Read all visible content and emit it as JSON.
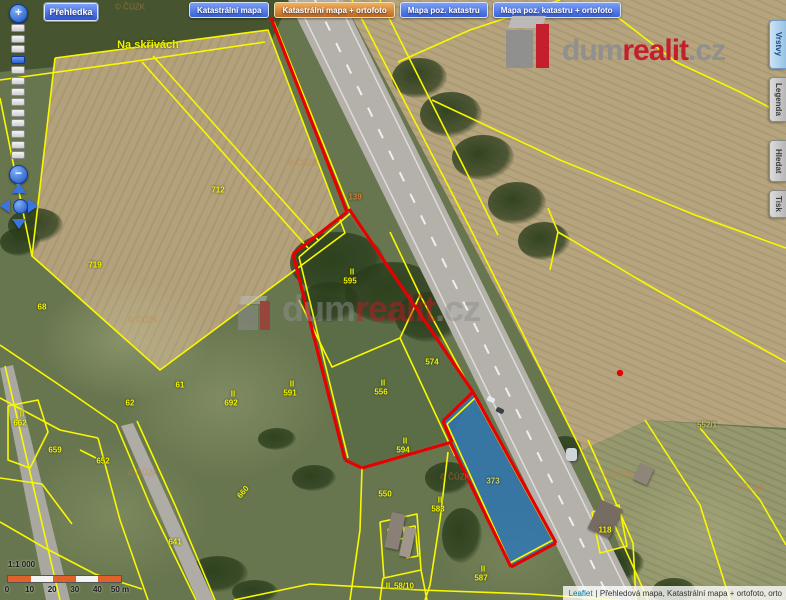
{
  "chrome": {
    "overview_button": "Přehledka",
    "map_buttons": [
      {
        "label": "Katastrální mapa",
        "active": false
      },
      {
        "label": "Katastrální mapa + ortofoto",
        "active": true
      },
      {
        "label": "Mapa poz. katastru",
        "active": false
      },
      {
        "label": "Mapa poz. katastru + ortofoto",
        "active": false
      }
    ],
    "side_tabs": [
      {
        "label": "Vrstvy",
        "active": true
      },
      {
        "label": "Legenda",
        "active": false
      },
      {
        "label": "Hledat",
        "active": false
      },
      {
        "label": "Tisk",
        "active": false
      }
    ],
    "zoom_in_glyph": "+",
    "zoom_out_glyph": "−",
    "logo": {
      "part1": "dum",
      "part2": "realit",
      "part3": ".cz"
    },
    "watermark": {
      "part1": "dum",
      "part2": "realit",
      "part3": ".cz"
    },
    "scalebar": {
      "ratio": "1:1 000",
      "ticks": [
        "0",
        "10",
        "20",
        "30",
        "40",
        "50 m"
      ]
    },
    "attribution": {
      "link": "Leaflet",
      "text": "| Přehledová mapa, Katastrální mapa + ortofoto, orto"
    }
  },
  "map": {
    "place_label": "Na skřivách",
    "copyright_text": "© ČÚZK",
    "copyright_marks": [
      {
        "x": 130,
        "y": 7
      },
      {
        "x": 303,
        "y": 163
      },
      {
        "x": 143,
        "y": 320
      },
      {
        "x": 455,
        "y": 477
      },
      {
        "x": 143,
        "y": 473
      },
      {
        "x": 618,
        "y": 475
      },
      {
        "x": 750,
        "y": 488
      }
    ],
    "labels": [
      {
        "text": "712",
        "x": 218,
        "y": 190
      },
      {
        "text": "719",
        "x": 95,
        "y": 265
      },
      {
        "text": "68",
        "x": 42,
        "y": 307
      },
      {
        "text": "61",
        "x": 180,
        "y": 385
      },
      {
        "text": "62",
        "x": 130,
        "y": 403
      },
      {
        "text": "II",
        "x": 233,
        "y": 394
      },
      {
        "text": "692",
        "x": 231,
        "y": 403
      },
      {
        "text": "II",
        "x": 22,
        "y": 414
      },
      {
        "text": "662",
        "x": 20,
        "y": 423
      },
      {
        "text": "659",
        "x": 55,
        "y": 450
      },
      {
        "text": "652",
        "x": 103,
        "y": 461
      },
      {
        "text": "641",
        "x": 175,
        "y": 542
      },
      {
        "text": "660",
        "x": 243,
        "y": 492,
        "rot": -50
      },
      {
        "text": "II",
        "x": 352,
        "y": 272
      },
      {
        "text": "595",
        "x": 350,
        "y": 281
      },
      {
        "text": "574",
        "x": 432,
        "y": 362
      },
      {
        "text": "II",
        "x": 292,
        "y": 384
      },
      {
        "text": "591",
        "x": 290,
        "y": 393
      },
      {
        "text": "II",
        "x": 383,
        "y": 383
      },
      {
        "text": "556",
        "x": 381,
        "y": 392
      },
      {
        "text": "II",
        "x": 405,
        "y": 441
      },
      {
        "text": "594",
        "x": 403,
        "y": 450
      },
      {
        "text": "550",
        "x": 385,
        "y": 494
      },
      {
        "text": "II",
        "x": 440,
        "y": 500
      },
      {
        "text": "583",
        "x": 438,
        "y": 509
      },
      {
        "text": "373",
        "x": 493,
        "y": 481,
        "cls": "inblue"
      },
      {
        "text": "II",
        "x": 483,
        "y": 569
      },
      {
        "text": "587",
        "x": 481,
        "y": 578
      },
      {
        "text": "II",
        "x": 388,
        "y": 586
      },
      {
        "text": "58/10",
        "x": 404,
        "y": 586
      },
      {
        "text": "139",
        "x": 355,
        "y": 197,
        "cls": "orange"
      },
      {
        "text": "552/1",
        "x": 707,
        "y": 425,
        "cls": "faint"
      },
      {
        "text": "118",
        "x": 605,
        "y": 530
      }
    ],
    "geometry": {
      "blue_parcel": [
        473,
        392,
        556,
        543,
        511,
        567,
        443,
        421
      ],
      "red_dot": {
        "x": 620,
        "y": 373
      },
      "red_lines": [
        [
          271,
          18,
          347,
          212
        ],
        [
          347,
          212,
          293,
          254
        ],
        [
          293,
          254,
          345,
          460
        ],
        [
          345,
          460,
          362,
          468
        ],
        [
          362,
          468,
          452,
          442
        ],
        [
          452,
          442,
          443,
          421
        ],
        [
          443,
          421,
          473,
          392
        ],
        [
          349,
          209,
          473,
          392
        ],
        [
          473,
          392,
          556,
          543
        ],
        [
          556,
          543,
          511,
          567
        ],
        [
          511,
          567,
          450,
          442
        ]
      ],
      "yellow_lines": [
        [
          55,
          58,
          268,
          30,
          345,
          233,
          160,
          370,
          32,
          256,
          55,
          58
        ],
        [
          142,
          62,
          308,
          248
        ],
        [
          153,
          56,
          319,
          241
        ],
        [
          0,
          80,
          130,
          62,
          265,
          42
        ],
        [
          0,
          98,
          32,
          256
        ],
        [
          274,
          22,
          350,
          210
        ],
        [
          352,
          212,
          299,
          257
        ],
        [
          299,
          257,
          348,
          458
        ],
        [
          352,
          0,
          470,
          228,
          580,
          448,
          648,
          600
        ],
        [
          380,
          0,
          498,
          235
        ],
        [
          398,
          62,
          470,
          30,
          560,
          0
        ],
        [
          432,
          100,
          560,
          160,
          695,
          215,
          786,
          248
        ],
        [
          598,
          2,
          676,
          62,
          740,
          92,
          786,
          116
        ],
        [
          548,
          208,
          558,
          232,
          550,
          270
        ],
        [
          558,
          232,
          660,
          292,
          786,
          362
        ],
        [
          390,
          232,
          420,
          295
        ],
        [
          420,
          295,
          400,
          338,
          332,
          367,
          299,
          300
        ],
        [
          420,
          295,
          470,
          388
        ],
        [
          400,
          338,
          455,
          456
        ],
        [
          362,
          468,
          360,
          530,
          350,
          600
        ],
        [
          448,
          452,
          440,
          520,
          430,
          585,
          425,
          600
        ],
        [
          380,
          522,
          417,
          514,
          421,
          570,
          384,
          578,
          380,
          522
        ],
        [
          388,
          529,
          403,
          526,
          405,
          538,
          390,
          541,
          388,
          529
        ],
        [
          404,
          528,
          415,
          526,
          418,
          556,
          407,
          558,
          404,
          528
        ],
        [
          383,
          578,
          380,
          600
        ],
        [
          421,
          570,
          427,
          600
        ],
        [
          234,
          600,
          310,
          584,
          420,
          590,
          530,
          594,
          620,
          600
        ],
        [
          588,
          440,
          612,
          494,
          633,
          543,
          636,
          600
        ],
        [
          592,
          512,
          619,
          505,
          627,
          546,
          600,
          553,
          592,
          512
        ],
        [
          645,
          420,
          700,
          505,
          730,
          600
        ],
        [
          700,
          428,
          760,
          500,
          786,
          545
        ],
        [
          116,
          424,
          150,
          505,
          196,
          600
        ],
        [
          137,
          421,
          175,
          505,
          215,
          600
        ],
        [
          98,
          438,
          120,
          520,
          148,
          600
        ],
        [
          0,
          345,
          55,
          382,
          116,
          424
        ],
        [
          0,
          398,
          60,
          430,
          98,
          438
        ],
        [
          8,
          406,
          38,
          400,
          48,
          432,
          30,
          468,
          8,
          460,
          8,
          406
        ],
        [
          0,
          478,
          42,
          484,
          72,
          524
        ],
        [
          0,
          522,
          45,
          548,
          95,
          574,
          142,
          589
        ],
        [
          5,
          366,
          60,
          600
        ],
        [
          80,
          450,
          96,
          458
        ],
        [
          475,
          398,
          553,
          540,
          510,
          563,
          447,
          424,
          475,
          398
        ]
      ]
    },
    "colors": {
      "parcel_line_yellow": "#f8f800",
      "highlight_outline_red": "#e60000",
      "selected_parcel_blue": "#2474c4",
      "button_blue": "#3a62d8",
      "button_orange_active": "#c06a1c",
      "brand_red": "#c41828",
      "brand_gray": "#8f8f8f",
      "scalebar_orange": "#e0622a",
      "attribution_link_blue": "#0078a8"
    }
  }
}
